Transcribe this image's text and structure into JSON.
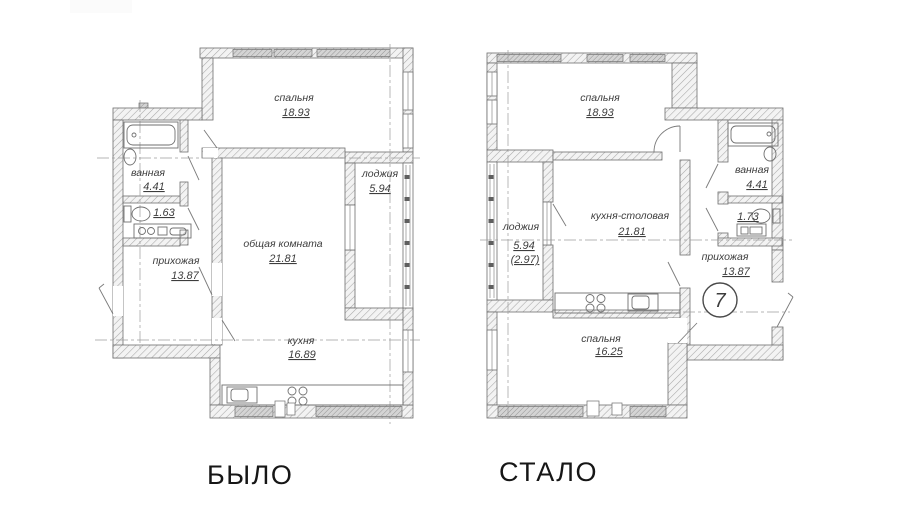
{
  "captions": {
    "before": "БЫЛО",
    "after": "СТАЛО"
  },
  "plan_before": {
    "bedroom_name": "спальня",
    "bedroom_area": "18.93",
    "bathroom_name": "ванная",
    "bathroom_area": "4.41",
    "wc_area": "1.63",
    "hallway_name": "прихожая",
    "hallway_area": "13.87",
    "living_name": "общая комната",
    "living_area": "21.81",
    "loggia_name": "лоджия",
    "loggia_area": "5.94",
    "kitchen_name": "кухня",
    "kitchen_area": "16.89"
  },
  "plan_after": {
    "bedroom1_name": "спальня",
    "bedroom1_area": "18.93",
    "bathroom_name": "ванная",
    "bathroom_area": "4.41",
    "wc_area": "1.73",
    "loggia_name": "лоджия",
    "loggia_area": "5.94",
    "loggia_area_reduced": "(2.97)",
    "kitchen_dining_name": "кухня-столовая",
    "kitchen_dining_area": "21.81",
    "hallway_name": "прихожая",
    "hallway_area": "13.87",
    "bedroom2_name": "спальня",
    "bedroom2_area": "16.25",
    "unit_number": "7"
  },
  "colors": {
    "background": "#ffffff",
    "linework": "#6e6e6e",
    "labels": "#3d3d3d"
  }
}
